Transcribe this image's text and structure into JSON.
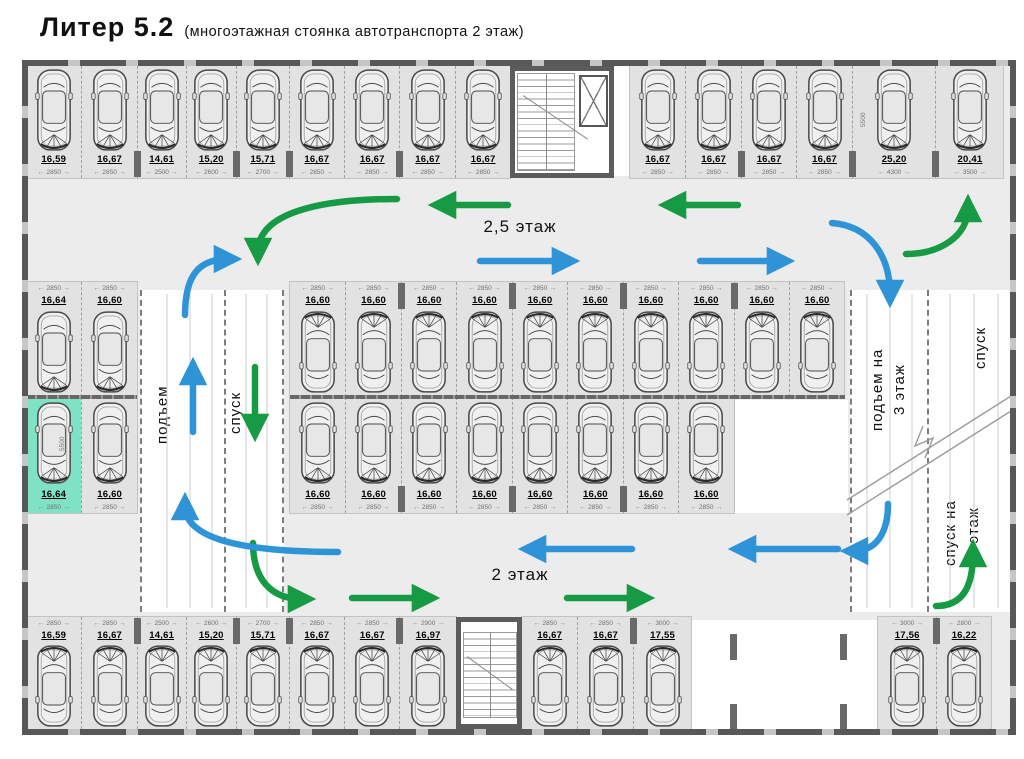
{
  "title": {
    "main": "Литер 5.2",
    "sub": "(многоэтажная стоянка автотранспорта 2 этаж)"
  },
  "floor_labels": {
    "upper": "2,5 этаж",
    "lower": "2 этаж"
  },
  "ramp_labels": {
    "left_up": "подъем",
    "left_down": "спуск",
    "right_up_line1": "подъем на",
    "right_up_line2": "3 этаж",
    "right_down_top": "спуск",
    "right_down_line1": "спуск на",
    "right_down_line2": "1 этаж"
  },
  "side_dims": {
    "left": "5500",
    "right": "5500"
  },
  "colors": {
    "blue": "#2f94d7",
    "green": "#169a43",
    "highlight": "#7fe2c4"
  },
  "rows": {
    "top_left": [
      {
        "v": "16,59",
        "d": "2850"
      },
      {
        "v": "16,67",
        "d": "2850",
        "p": 1
      },
      {
        "v": "14,61",
        "d": "2500"
      },
      {
        "v": "15,20",
        "d": "2600",
        "p": 1
      },
      {
        "v": "15,71",
        "d": "2700",
        "p": 1
      },
      {
        "v": "16,67",
        "d": "2850"
      },
      {
        "v": "16,67",
        "d": "2850",
        "p": 1
      },
      {
        "v": "16,67",
        "d": "2850"
      },
      {
        "v": "16,67",
        "d": "2850"
      }
    ],
    "top_right": [
      {
        "v": "16,67",
        "d": "2850"
      },
      {
        "v": "16,67",
        "d": "2850",
        "p": 1
      },
      {
        "v": "16,67",
        "d": "2850"
      },
      {
        "v": "16,67",
        "d": "2850",
        "p": 1
      },
      {
        "v": "25,20",
        "d": "4300",
        "p": 1
      },
      {
        "v": "20,41",
        "d": "3500"
      }
    ],
    "mid_upper": [
      {
        "v": "16,60",
        "d": "2850"
      },
      {
        "v": "16,60",
        "d": "2850",
        "p": 1
      },
      {
        "v": "16,60",
        "d": "2850"
      },
      {
        "v": "16,60",
        "d": "2850",
        "p": 1
      },
      {
        "v": "16,60",
        "d": "2850"
      },
      {
        "v": "16,60",
        "d": "2850",
        "p": 1
      },
      {
        "v": "16,60",
        "d": "2850"
      },
      {
        "v": "16,60",
        "d": "2850",
        "p": 1
      },
      {
        "v": "16,60",
        "d": "2850"
      },
      {
        "v": "16,60",
        "d": "2850"
      }
    ],
    "mid_lower": [
      {
        "v": "16,60",
        "d": "2850"
      },
      {
        "v": "16,60",
        "d": "2850",
        "p": 1
      },
      {
        "v": "16,60",
        "d": "2850"
      },
      {
        "v": "16,60",
        "d": "2850",
        "p": 1
      },
      {
        "v": "16,60",
        "d": "2850"
      },
      {
        "v": "16,60",
        "d": "2850",
        "p": 1
      },
      {
        "v": "16,60",
        "d": "2850"
      },
      {
        "v": "16,60",
        "d": "2850"
      }
    ],
    "left_upper": [
      {
        "v": "16,64",
        "d": "2850"
      },
      {
        "v": "16,60",
        "d": "2850"
      }
    ],
    "left_lower": [
      {
        "v": "16,64",
        "d": "2850",
        "hl": 1
      },
      {
        "v": "16,60",
        "d": "2850"
      }
    ],
    "bottom_left": [
      {
        "v": "16,59",
        "d": "2850"
      },
      {
        "v": "16,67",
        "d": "2850",
        "p": 1
      },
      {
        "v": "14,61",
        "d": "2500"
      },
      {
        "v": "15,20",
        "d": "2600",
        "p": 1
      },
      {
        "v": "15,71",
        "d": "2700",
        "p": 1
      },
      {
        "v": "16,67",
        "d": "2850"
      },
      {
        "v": "16,67",
        "d": "2850",
        "p": 1
      },
      {
        "v": "16,97",
        "d": "2900"
      }
    ],
    "bottom_mid": [
      {
        "v": "16,67",
        "d": "2850"
      },
      {
        "v": "16,67",
        "d": "2850",
        "p": 1
      },
      {
        "v": "17,55",
        "d": "3000"
      }
    ],
    "bottom_right": [
      {
        "v": "17,56",
        "d": "3000",
        "p": 1
      },
      {
        "v": "16,22",
        "d": "2800"
      }
    ]
  }
}
